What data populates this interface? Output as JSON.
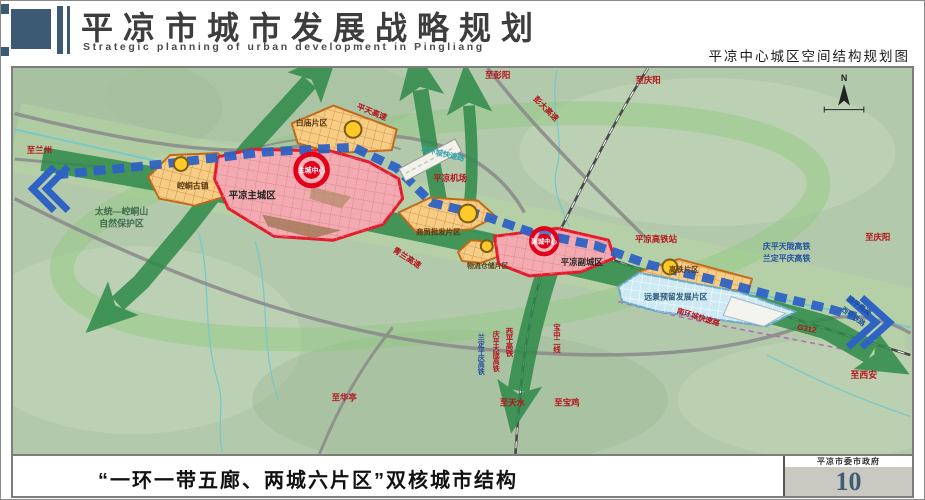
{
  "header": {
    "title": "平凉市城市发展战略规划",
    "subtitle": "Strategic planning of urban development in Pingliang",
    "map_caption": "平凉中心城区空间结构规划图"
  },
  "footer": {
    "structure_title": "“一环一带五廊、两城六片区”双核城市结构",
    "agency": "平凉市委市政府",
    "page_number": "10"
  },
  "map": {
    "compass": "N",
    "labels": {
      "to_lanzhou": "至兰州",
      "reserve_line1": "太统—崆峒山",
      "reserve_line2": "自然保护区",
      "kongtong_town": "崆峒古镇",
      "main_city": "平凉主城区",
      "main_core": "主城中心",
      "baimiao_district": "白庙片区",
      "pingtian_expwy": "平天高速",
      "north_ring_expwy": "北环城快速路",
      "airport": "平凉机场",
      "trade_district": "商贸批发片区",
      "qinglan_expwy": "青兰高速",
      "logistics_district": "物流仓储片区",
      "sub_core": "副城中心",
      "sub_city": "平凉副城区",
      "hsr_station": "平凉高铁站",
      "hsr_line1": "庆平天陇高铁",
      "hsr_line2": "兰定平庆高铁",
      "to_qingyang_east": "至庆阳",
      "to_qingyang_north": "至庆阳",
      "to_pengyang": "至彭阳",
      "pengda_expwy": "彭大高速",
      "hsr_district": "高铁片区",
      "reserved_district": "远景预留发展片区",
      "south_ring_expwy": "南环城快速路",
      "g312": "G312",
      "jingping_expwy": "泾平高速",
      "xiping_railway": "西平铁路",
      "to_xian": "至西安",
      "to_huating": "至华亭",
      "to_tianshui": "至天水",
      "to_baoji": "至宝鸡",
      "baozhong_line2": "宝中二线",
      "xiping_hsr": "西平高铁",
      "qingping_hsr": "庆平天陇高铁",
      "lanping_hsr": "兰定平庆高铁"
    },
    "colors": {
      "header_accent": "#3c5a74",
      "core_red": "#e3001b",
      "city_fill": "#f3abb1",
      "district_orange": "#f7cd85",
      "reserved_blue": "#cde9f3",
      "corridor_green": "#2f8a4a",
      "belt_blue": "#2e62c4",
      "page_number_color": "#3f5d77"
    }
  }
}
